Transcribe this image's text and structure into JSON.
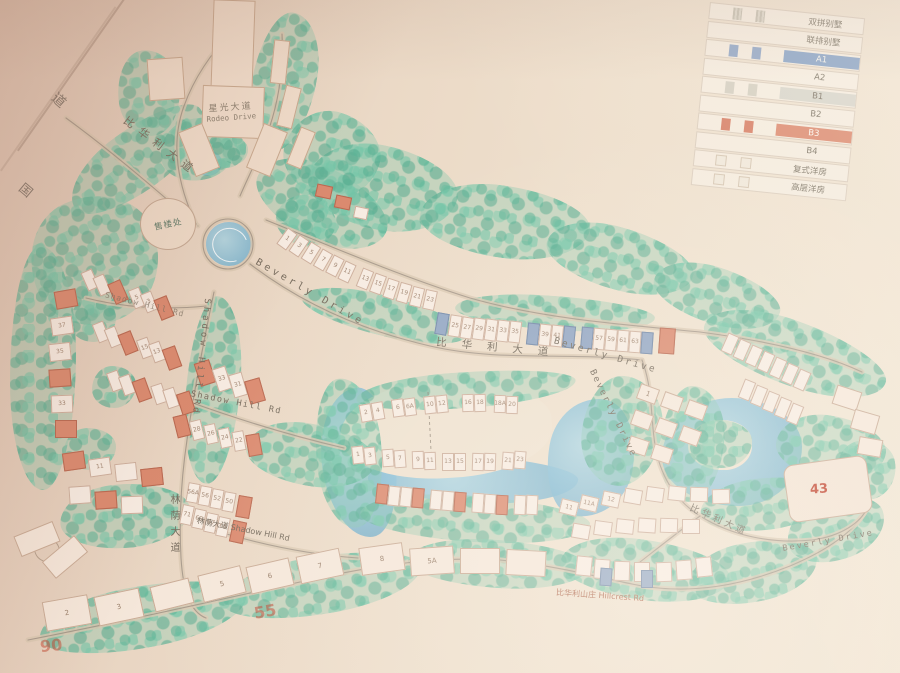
{
  "legend": {
    "items": [
      {
        "label": "双拼别墅"
      },
      {
        "label": "联排别墅"
      },
      {
        "label": "A1",
        "chip": "#8ea6c6"
      },
      {
        "label": "A2"
      },
      {
        "label": "B1",
        "chip": "#d9d6cb"
      },
      {
        "label": "B2"
      },
      {
        "label": "B3",
        "chip": "#dd8e74"
      },
      {
        "label": "B4"
      },
      {
        "label": "复式洋房"
      },
      {
        "label": "高层洋房"
      }
    ]
  },
  "roads": {
    "bihuali_top": "比华利大道",
    "beverly_top": "Beverly Drive",
    "bihuali_mid": "比华利大道",
    "beverly_mid": "Beverly Drive",
    "beverly_right": "Beverly Drive",
    "bihuali_bottom": "比华利大道",
    "beverly_bottom": "Beverly Drive",
    "shadow_vertical": "Shadow Hill Rd",
    "shadow_west": "Shadow Hill Rd",
    "shadow_mid": "Shadow Hill Rd",
    "linyin_vertical": "林荫大道",
    "linyin_horizontal": "林荫大道 Shadow Hill Rd",
    "hillcrest": "比华利山庄 Hillcrest Rd"
  },
  "landmarks": {
    "sales_office": "售楼处",
    "rodeo_cn": "星光大道",
    "rodeo_en": "Rodeo Drive",
    "stamp_top": "道",
    "stamp_bottom": "国"
  },
  "annotations": {
    "building_43": "43",
    "hand_55": "55",
    "hand_90": "90"
  },
  "colors": {
    "paper": "#ecd9c7",
    "tree_green": "#8fcab0",
    "water_blue": "#85bdd6",
    "house_white": "#f7ece2",
    "b3_red": "#db8a6f",
    "a1_blue": "#93a7c4",
    "road": "#93867a"
  },
  "map": {
    "buildings": [
      [
        281,
        229,
        12,
        20,
        36,
        0,
        "1"
      ],
      [
        293,
        236,
        12,
        20,
        34,
        0,
        "3"
      ],
      [
        305,
        243,
        12,
        20,
        32,
        0,
        "5"
      ],
      [
        317,
        250,
        12,
        20,
        30,
        0,
        "7"
      ],
      [
        329,
        256,
        12,
        20,
        27,
        0,
        "9"
      ],
      [
        341,
        262,
        12,
        20,
        25,
        0,
        "11"
      ],
      [
        359,
        269,
        12,
        20,
        22,
        0,
        "13"
      ],
      [
        372,
        274,
        12,
        20,
        20,
        0,
        "15"
      ],
      [
        385,
        279,
        12,
        20,
        18,
        0,
        "17"
      ],
      [
        398,
        283,
        12,
        20,
        16,
        0,
        "19"
      ],
      [
        411,
        287,
        12,
        20,
        14,
        0,
        "21"
      ],
      [
        424,
        290,
        12,
        20,
        12,
        0,
        "23"
      ],
      [
        436,
        313,
        12,
        22,
        10,
        2,
        ""
      ],
      [
        449,
        315,
        12,
        22,
        9,
        0,
        "25"
      ],
      [
        461,
        317,
        12,
        22,
        9,
        0,
        "27"
      ],
      [
        473,
        318,
        12,
        22,
        8,
        0,
        "29"
      ],
      [
        485,
        319,
        12,
        22,
        8,
        0,
        "31"
      ],
      [
        497,
        320,
        12,
        22,
        7,
        0,
        "33"
      ],
      [
        509,
        321,
        12,
        22,
        7,
        0,
        "35"
      ],
      [
        527,
        323,
        12,
        22,
        6,
        2,
        ""
      ],
      [
        539,
        324,
        12,
        22,
        6,
        0,
        "39"
      ],
      [
        551,
        325,
        12,
        22,
        6,
        0,
        "41"
      ],
      [
        563,
        326,
        12,
        22,
        6,
        2,
        ""
      ],
      [
        581,
        327,
        12,
        22,
        5,
        2,
        ""
      ],
      [
        593,
        328,
        12,
        22,
        5,
        0,
        "57"
      ],
      [
        605,
        329,
        12,
        22,
        5,
        0,
        "59"
      ],
      [
        617,
        330,
        12,
        22,
        4,
        0,
        "61"
      ],
      [
        629,
        331,
        12,
        22,
        4,
        0,
        "63"
      ],
      [
        641,
        332,
        12,
        22,
        4,
        2,
        ""
      ],
      [
        659,
        328,
        16,
        26,
        4,
        1,
        ""
      ],
      [
        316,
        185,
        16,
        13,
        12,
        1,
        ""
      ],
      [
        335,
        196,
        16,
        13,
        12,
        1,
        ""
      ],
      [
        354,
        207,
        14,
        12,
        12,
        0,
        ""
      ],
      [
        724,
        334,
        12,
        20,
        24,
        0,
        ""
      ],
      [
        736,
        340,
        12,
        20,
        24,
        0,
        ""
      ],
      [
        748,
        346,
        12,
        20,
        24,
        0,
        ""
      ],
      [
        760,
        352,
        12,
        20,
        24,
        0,
        ""
      ],
      [
        772,
        358,
        12,
        20,
        24,
        0,
        ""
      ],
      [
        784,
        364,
        12,
        20,
        24,
        0,
        ""
      ],
      [
        796,
        370,
        12,
        20,
        24,
        0,
        ""
      ],
      [
        741,
        380,
        12,
        20,
        22,
        0,
        ""
      ],
      [
        753,
        386,
        12,
        20,
        22,
        0,
        ""
      ],
      [
        765,
        392,
        12,
        20,
        22,
        0,
        ""
      ],
      [
        777,
        398,
        12,
        20,
        22,
        0,
        ""
      ],
      [
        789,
        404,
        12,
        20,
        22,
        0,
        ""
      ],
      [
        834,
        388,
        26,
        20,
        18,
        3,
        ""
      ],
      [
        852,
        412,
        26,
        20,
        16,
        3,
        ""
      ],
      [
        858,
        438,
        24,
        18,
        10,
        3,
        ""
      ],
      [
        638,
        386,
        20,
        16,
        20,
        3,
        "1"
      ],
      [
        662,
        394,
        20,
        16,
        20,
        3,
        ""
      ],
      [
        686,
        402,
        20,
        16,
        20,
        3,
        ""
      ],
      [
        632,
        412,
        20,
        16,
        20,
        3,
        ""
      ],
      [
        656,
        420,
        20,
        16,
        20,
        3,
        ""
      ],
      [
        680,
        428,
        20,
        16,
        20,
        3,
        ""
      ],
      [
        628,
        438,
        20,
        16,
        18,
        3,
        ""
      ],
      [
        652,
        446,
        20,
        16,
        18,
        3,
        ""
      ],
      [
        360,
        404,
        12,
        18,
        -10,
        0,
        "2"
      ],
      [
        372,
        402,
        12,
        18,
        -10,
        0,
        "4"
      ],
      [
        392,
        399,
        12,
        18,
        -8,
        0,
        "6"
      ],
      [
        404,
        398,
        12,
        18,
        -8,
        0,
        "6A"
      ],
      [
        424,
        396,
        12,
        18,
        -6,
        0,
        "10"
      ],
      [
        436,
        395,
        12,
        18,
        -6,
        0,
        "12"
      ],
      [
        462,
        394,
        12,
        18,
        -2,
        0,
        "16"
      ],
      [
        474,
        394,
        12,
        18,
        -2,
        0,
        "18"
      ],
      [
        494,
        395,
        12,
        18,
        2,
        0,
        "18A"
      ],
      [
        506,
        396,
        12,
        18,
        2,
        0,
        "20"
      ],
      [
        352,
        446,
        12,
        18,
        -6,
        0,
        "1"
      ],
      [
        364,
        447,
        12,
        18,
        -6,
        0,
        "3"
      ],
      [
        382,
        449,
        12,
        18,
        -4,
        0,
        "5"
      ],
      [
        394,
        450,
        12,
        18,
        -4,
        0,
        "7"
      ],
      [
        412,
        451,
        12,
        18,
        -2,
        0,
        "9"
      ],
      [
        424,
        452,
        12,
        18,
        -2,
        0,
        "11"
      ],
      [
        442,
        453,
        12,
        18,
        0,
        0,
        "13"
      ],
      [
        454,
        453,
        12,
        18,
        0,
        0,
        "15"
      ],
      [
        472,
        453,
        12,
        18,
        2,
        0,
        "17"
      ],
      [
        484,
        453,
        12,
        18,
        2,
        0,
        "19"
      ],
      [
        502,
        452,
        12,
        18,
        4,
        0,
        "21"
      ],
      [
        514,
        451,
        12,
        18,
        4,
        0,
        "23"
      ],
      [
        376,
        484,
        12,
        20,
        6,
        1,
        ""
      ],
      [
        388,
        486,
        12,
        20,
        6,
        0,
        ""
      ],
      [
        400,
        487,
        12,
        20,
        6,
        0,
        ""
      ],
      [
        412,
        488,
        12,
        20,
        5,
        1,
        ""
      ],
      [
        430,
        490,
        12,
        20,
        5,
        0,
        ""
      ],
      [
        442,
        491,
        12,
        20,
        5,
        0,
        ""
      ],
      [
        454,
        492,
        12,
        20,
        4,
        1,
        ""
      ],
      [
        472,
        493,
        12,
        20,
        4,
        0,
        ""
      ],
      [
        484,
        494,
        12,
        20,
        4,
        0,
        ""
      ],
      [
        496,
        495,
        12,
        20,
        3,
        1,
        ""
      ],
      [
        514,
        495,
        12,
        20,
        3,
        0,
        ""
      ],
      [
        526,
        495,
        12,
        20,
        3,
        0,
        ""
      ],
      [
        84,
        270,
        12,
        20,
        -24,
        0,
        ""
      ],
      [
        96,
        275,
        12,
        20,
        -24,
        0,
        ""
      ],
      [
        111,
        281,
        14,
        22,
        -24,
        1,
        ""
      ],
      [
        131,
        288,
        12,
        20,
        -22,
        0,
        "5"
      ],
      [
        143,
        292,
        12,
        20,
        -22,
        0,
        "3"
      ],
      [
        157,
        297,
        14,
        22,
        -22,
        1,
        ""
      ],
      [
        95,
        322,
        12,
        20,
        -22,
        0,
        ""
      ],
      [
        107,
        327,
        12,
        20,
        -22,
        0,
        ""
      ],
      [
        121,
        332,
        14,
        22,
        -22,
        1,
        ""
      ],
      [
        139,
        338,
        12,
        20,
        -20,
        0,
        "15"
      ],
      [
        151,
        342,
        12,
        20,
        -20,
        0,
        "13"
      ],
      [
        165,
        347,
        14,
        22,
        -20,
        1,
        ""
      ],
      [
        109,
        371,
        12,
        20,
        -20,
        0,
        ""
      ],
      [
        121,
        375,
        12,
        20,
        -20,
        0,
        ""
      ],
      [
        135,
        379,
        14,
        22,
        -20,
        1,
        ""
      ],
      [
        153,
        384,
        12,
        20,
        -18,
        0,
        ""
      ],
      [
        165,
        388,
        12,
        20,
        -18,
        0,
        ""
      ],
      [
        179,
        392,
        14,
        22,
        -18,
        1,
        ""
      ],
      [
        55,
        290,
        22,
        18,
        -10,
        1,
        ""
      ],
      [
        51,
        317,
        22,
        18,
        -8,
        0,
        "37"
      ],
      [
        49,
        343,
        22,
        18,
        -6,
        0,
        "35"
      ],
      [
        49,
        369,
        22,
        18,
        -4,
        1,
        ""
      ],
      [
        51,
        395,
        22,
        18,
        -2,
        0,
        "33"
      ],
      [
        55,
        420,
        22,
        18,
        0,
        1,
        ""
      ],
      [
        197,
        361,
        16,
        24,
        -18,
        1,
        ""
      ],
      [
        215,
        367,
        14,
        24,
        -18,
        0,
        "33"
      ],
      [
        231,
        373,
        14,
        24,
        -16,
        0,
        "31"
      ],
      [
        247,
        379,
        16,
        24,
        -16,
        1,
        ""
      ],
      [
        175,
        415,
        14,
        22,
        -14,
        1,
        ""
      ],
      [
        191,
        420,
        12,
        20,
        -14,
        0,
        "28"
      ],
      [
        205,
        424,
        12,
        20,
        -12,
        0,
        "26"
      ],
      [
        219,
        428,
        12,
        20,
        -12,
        0,
        "24"
      ],
      [
        233,
        431,
        12,
        20,
        -10,
        0,
        "22"
      ],
      [
        247,
        434,
        14,
        22,
        -10,
        1,
        ""
      ],
      [
        63,
        452,
        22,
        18,
        -8,
        1,
        ""
      ],
      [
        89,
        458,
        22,
        18,
        -8,
        0,
        "11"
      ],
      [
        115,
        463,
        22,
        18,
        -6,
        0,
        ""
      ],
      [
        141,
        468,
        22,
        18,
        -6,
        1,
        ""
      ],
      [
        69,
        486,
        22,
        18,
        -4,
        0,
        ""
      ],
      [
        95,
        491,
        22,
        18,
        -4,
        1,
        ""
      ],
      [
        121,
        496,
        22,
        18,
        -2,
        0,
        ""
      ],
      [
        187,
        483,
        12,
        20,
        10,
        0,
        "56A"
      ],
      [
        199,
        486,
        12,
        20,
        10,
        0,
        "56"
      ],
      [
        211,
        489,
        12,
        20,
        10,
        0,
        "52"
      ],
      [
        223,
        492,
        12,
        20,
        10,
        0,
        "50"
      ],
      [
        237,
        496,
        14,
        22,
        10,
        1,
        ""
      ],
      [
        181,
        505,
        12,
        20,
        12,
        0,
        "71"
      ],
      [
        193,
        509,
        12,
        20,
        12,
        0,
        "69"
      ],
      [
        205,
        513,
        12,
        20,
        12,
        0,
        "67"
      ],
      [
        217,
        517,
        12,
        20,
        12,
        0,
        "65"
      ],
      [
        231,
        521,
        14,
        22,
        12,
        1,
        ""
      ],
      [
        16,
        528,
        42,
        22,
        -22,
        3,
        ""
      ],
      [
        44,
        546,
        42,
        22,
        -40,
        3,
        ""
      ],
      [
        44,
        598,
        46,
        30,
        -10,
        3,
        "2"
      ],
      [
        96,
        592,
        46,
        30,
        -12,
        3,
        "3"
      ],
      [
        152,
        582,
        40,
        26,
        -14,
        3,
        ""
      ],
      [
        200,
        570,
        44,
        28,
        -14,
        3,
        "5"
      ],
      [
        248,
        562,
        44,
        28,
        -13,
        3,
        "6"
      ],
      [
        298,
        552,
        44,
        28,
        -12,
        3,
        "7"
      ],
      [
        360,
        545,
        44,
        28,
        -8,
        3,
        "8"
      ],
      [
        410,
        547,
        44,
        28,
        -4,
        3,
        "5A"
      ],
      [
        460,
        548,
        40,
        26,
        0,
        3,
        ""
      ],
      [
        506,
        550,
        40,
        26,
        3,
        3,
        ""
      ],
      [
        560,
        500,
        18,
        15,
        14,
        0,
        "11"
      ],
      [
        580,
        496,
        18,
        15,
        13,
        0,
        "11A"
      ],
      [
        602,
        492,
        18,
        15,
        12,
        0,
        "12"
      ],
      [
        624,
        489,
        18,
        15,
        10,
        0,
        ""
      ],
      [
        646,
        487,
        18,
        15,
        8,
        0,
        ""
      ],
      [
        668,
        486,
        18,
        15,
        6,
        0,
        ""
      ],
      [
        690,
        487,
        18,
        15,
        2,
        0,
        ""
      ],
      [
        712,
        489,
        18,
        15,
        -2,
        0,
        ""
      ],
      [
        572,
        524,
        18,
        15,
        10,
        0,
        ""
      ],
      [
        594,
        521,
        18,
        15,
        8,
        0,
        ""
      ],
      [
        616,
        519,
        18,
        15,
        6,
        0,
        ""
      ],
      [
        638,
        518,
        18,
        15,
        4,
        0,
        ""
      ],
      [
        660,
        518,
        18,
        15,
        2,
        0,
        ""
      ],
      [
        682,
        519,
        18,
        15,
        0,
        0,
        ""
      ],
      [
        576,
        556,
        16,
        20,
        6,
        0,
        ""
      ],
      [
        594,
        559,
        16,
        20,
        4,
        0,
        ""
      ],
      [
        600,
        568,
        12,
        18,
        4,
        2,
        ""
      ],
      [
        614,
        561,
        16,
        20,
        2,
        0,
        ""
      ],
      [
        634,
        562,
        16,
        20,
        0,
        0,
        ""
      ],
      [
        641,
        570,
        12,
        18,
        0,
        2,
        ""
      ],
      [
        656,
        562,
        16,
        20,
        -2,
        0,
        ""
      ],
      [
        676,
        560,
        16,
        20,
        -4,
        0,
        ""
      ],
      [
        696,
        557,
        16,
        20,
        -6,
        0,
        ""
      ],
      [
        786,
        460,
        84,
        58,
        -8,
        4,
        ""
      ]
    ]
  }
}
